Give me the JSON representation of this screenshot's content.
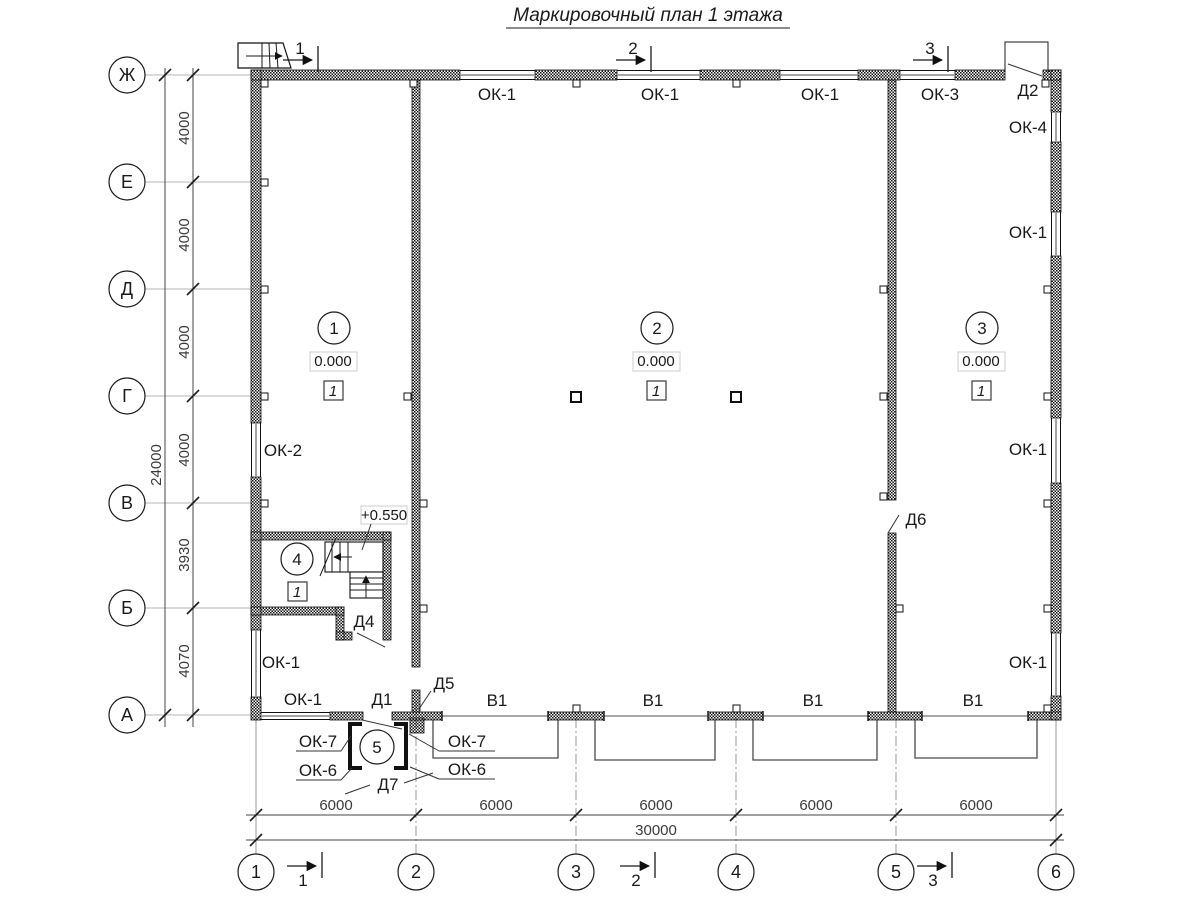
{
  "title": "Маркировочный план 1 этажа",
  "drawing_colors": {
    "ink": "#1a1a1a",
    "aux_gray": "#9a9a9a",
    "paper": "#ffffff"
  },
  "grid": {
    "rows": [
      "Ж",
      "Е",
      "Д",
      "Г",
      "В",
      "Б",
      "А"
    ],
    "cols": [
      "1",
      "2",
      "3",
      "4",
      "5",
      "6"
    ]
  },
  "dims": {
    "left": [
      "4000",
      "4000",
      "4000",
      "4000",
      "3930",
      "4070"
    ],
    "left_total": "24000",
    "bottom": [
      "6000",
      "6000",
      "6000",
      "6000",
      "6000"
    ],
    "bottom_total": "30000"
  },
  "sections": [
    "1",
    "2",
    "3"
  ],
  "rooms": {
    "r1": {
      "num": "1",
      "elev": "0.000",
      "floor": "1"
    },
    "r2": {
      "num": "2",
      "elev": "0.000",
      "floor": "1"
    },
    "r3": {
      "num": "3",
      "elev": "0.000",
      "floor": "1"
    },
    "r4": {
      "num": "4",
      "floor": "1"
    },
    "r5": {
      "num": "5"
    }
  },
  "stair": {
    "elev": "+0.550"
  },
  "windows": {
    "top": [
      "ОК-1",
      "ОК-1",
      "ОК-1",
      "ОК-3"
    ],
    "right": [
      "ОК-4",
      "ОК-1",
      "ОК-1",
      "ОК-1"
    ],
    "left": [
      "ОК-2",
      "ОК-1"
    ],
    "bottom": [
      "ОК-1"
    ],
    "vest": [
      "ОК-7",
      "ОК-7",
      "ОК-6",
      "ОК-6"
    ]
  },
  "doors": {
    "d1": "Д1",
    "d2": "Д2",
    "d4": "Д4",
    "d5": "Д5",
    "d6": "Д6",
    "d7": "Д7"
  },
  "gates": [
    "В1",
    "В1",
    "В1",
    "В1"
  ]
}
